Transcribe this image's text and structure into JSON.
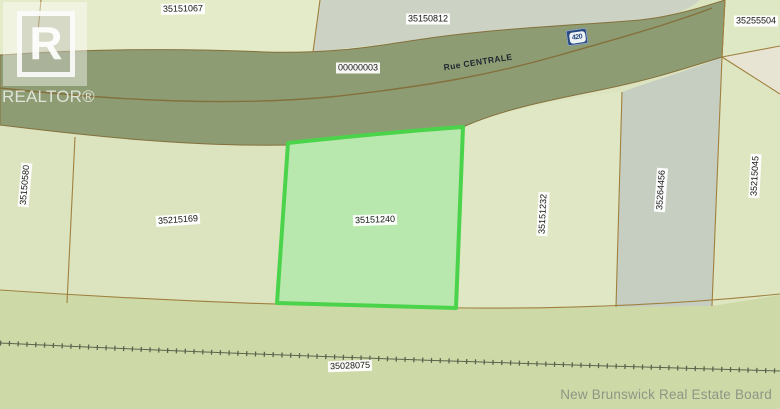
{
  "map": {
    "road": {
      "name": "Rue CENTRALE",
      "route_shield": "420"
    },
    "parcels": [
      {
        "id": "35151067",
        "highlighted": false
      },
      {
        "id": "35150812",
        "highlighted": false
      },
      {
        "id": "35255504",
        "highlighted": false
      },
      {
        "id": "00000003",
        "highlighted": false
      },
      {
        "id": "35150580",
        "highlighted": false
      },
      {
        "id": "35215169",
        "highlighted": false
      },
      {
        "id": "35151240",
        "highlighted": true
      },
      {
        "id": "35151232",
        "highlighted": false
      },
      {
        "id": "35264456",
        "highlighted": false
      },
      {
        "id": "35215045",
        "highlighted": false
      },
      {
        "id": "35028075",
        "highlighted": false
      }
    ],
    "highlight": {
      "fill": "#b9e8ae",
      "border": "#4bd44b"
    },
    "colors": {
      "road_band": "#8e9c73",
      "road_edge": "#84703c",
      "boundary_line": "#a0803f",
      "rail_line": "#5a644c",
      "base_parcel": "#dce4bf",
      "bottom_parcel": "#cddaa8",
      "gray_parcel": "#c6cec1"
    }
  },
  "watermark": {
    "logo_letter": "R",
    "logo_text": "REALTOR®"
  },
  "attribution": "New Brunswick Real Estate Board"
}
